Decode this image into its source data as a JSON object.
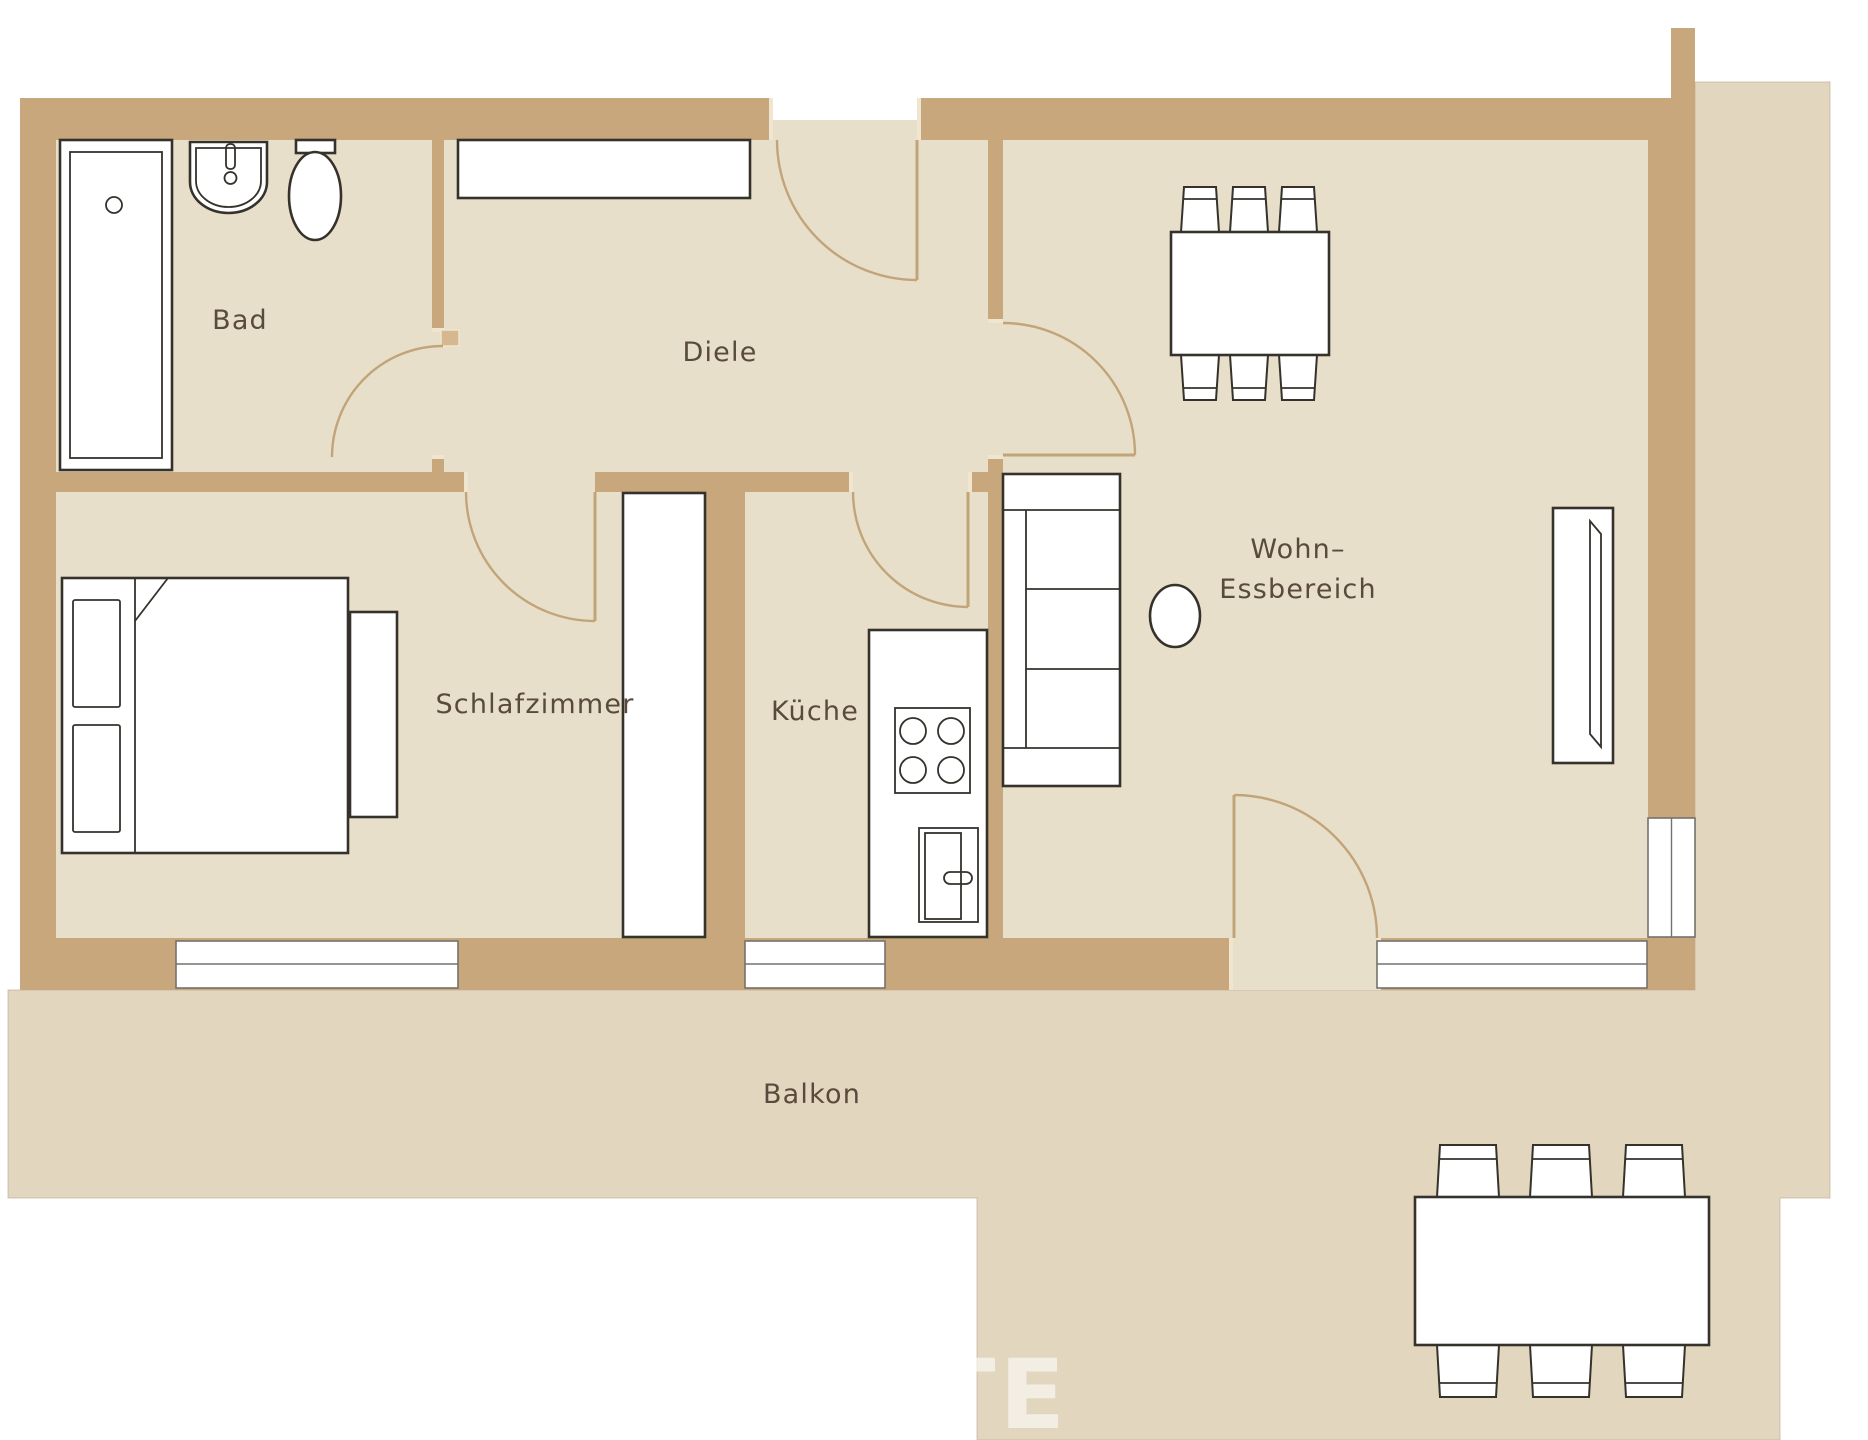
{
  "plan": {
    "type": "apartment-floor-plan",
    "language": "de"
  },
  "rooms": {
    "bad": {
      "label": "Bad"
    },
    "diele": {
      "label": "Diele"
    },
    "schlafzimmer": {
      "label": "Schlafzimmer"
    },
    "kueche": {
      "label": "Küche"
    },
    "wohn": {
      "label_line1": "Wohn–",
      "label_line2": "Essbereich"
    },
    "balkon": {
      "label": "Balkon"
    }
  },
  "watermark": {
    "text": "TE"
  },
  "colors": {
    "wall": "#C7A77B",
    "floor": "#E8DFCB",
    "outdoor": "#E2D6BF",
    "arc": "#C2A479",
    "ink": "#35322C",
    "winline": "#75726C",
    "label": "#5A4A3C",
    "cap": "#F0E5CF",
    "leaf": "#D5B88F"
  }
}
